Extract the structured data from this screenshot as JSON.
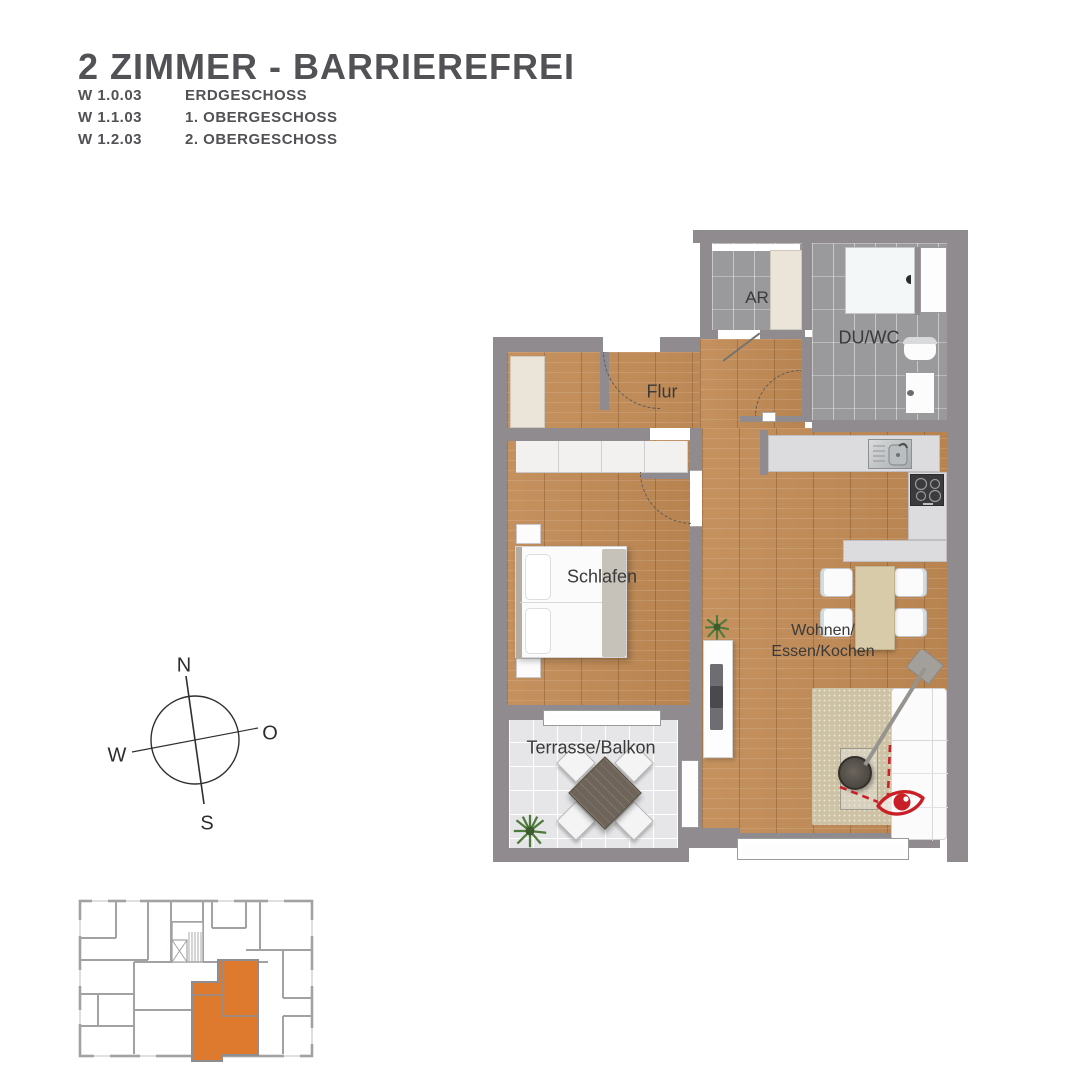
{
  "title": "2 ZIMMER - BARRIEREFREI",
  "units": [
    {
      "code": "W 1.0.03",
      "floor": "ERDGESCHOSS"
    },
    {
      "code": "W 1.1.03",
      "floor": "1. OBERGESCHOSS"
    },
    {
      "code": "W 1.2.03",
      "floor": "2. OBERGESCHOSS"
    }
  ],
  "rooms": {
    "ar": "AR",
    "du_wc": "DU/WC",
    "flur": "Flur",
    "schlafen": "Schlafen",
    "wohnen_line1": "Wohnen/",
    "wohnen_line2": "Essen/Kochen",
    "terrasse": "Terrasse/Balkon"
  },
  "compass": {
    "north": "N",
    "east": "O",
    "south": "S",
    "west": "W"
  },
  "theme": {
    "title_color": "#515156",
    "wall_color": "#8f8b8f",
    "wood_color": "#c18a54",
    "tile_color": "#9a999b",
    "terrace_tile_color": "#e6e6e8",
    "counter_color": "#dcdcde",
    "cream_color": "#ebe4d9",
    "highlight_orange": "#dd7a2e",
    "view_red": "#c92028"
  }
}
